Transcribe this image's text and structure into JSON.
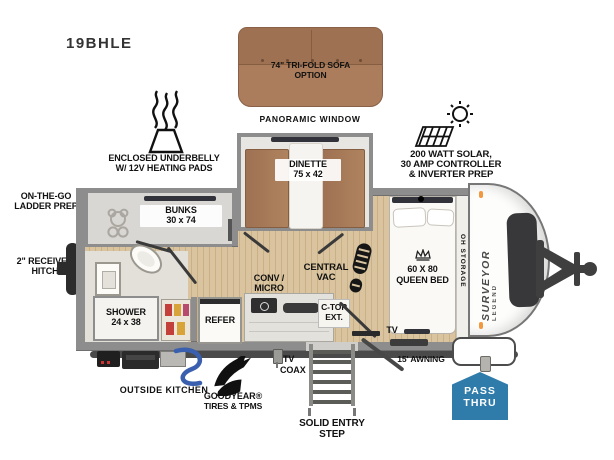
{
  "model": "19BHLE",
  "colors": {
    "accent_blue": "#2f7cab",
    "sofa_brown": "#ab7d5d",
    "wall_gray": "#8d8d8d",
    "floor_wood": "#d9c49f",
    "hose_blue": "#3a5fae",
    "marker_orange": "#f2993f"
  },
  "labels": {
    "tri_fold_sofa": [
      "74\" TRI-FOLD SOFA",
      "OPTION"
    ],
    "panoramic_window": "PANORAMIC WINDOW",
    "enclosed_underbelly": [
      "ENCLOSED UNDERBELLY",
      "W/ 12V HEATING PADS"
    ],
    "solar_prep": [
      "200 WATT SOLAR,",
      "30 AMP CONTROLLER",
      "& INVERTER PREP"
    ],
    "ladder_prep": [
      "ON-THE-GO",
      "LADDER PREP"
    ],
    "receiver_hitch": [
      "2\" RECEIVER",
      "HITCH"
    ],
    "bunks": [
      "BUNKS",
      "30 x 74"
    ],
    "dinette": [
      "DINETTE",
      "75 x 42"
    ],
    "central_vac": [
      "CENTRAL",
      "VAC"
    ],
    "queen_bed": [
      "60 X 80",
      "QUEEN BED"
    ],
    "oh_storage": "OH STORAGE",
    "brand": [
      "SURVEYOR",
      "LEGEND"
    ],
    "shower": [
      "SHOWER",
      "24 x 38"
    ],
    "refer": "REFER",
    "conv_micro": [
      "CONV /",
      "MICRO"
    ],
    "ctop_ext": [
      "C-TOP",
      "EXT."
    ],
    "tv": "TV",
    "tv_coax": [
      "TV",
      "COAX"
    ],
    "outside_kitchen": "OUTSIDE KITCHEN",
    "goodyear": [
      "GOODYEAR®",
      "TIRES & TPMS"
    ],
    "solid_entry_step": [
      "SOLID ENTRY",
      "STEP"
    ],
    "awning": "15' AWNING",
    "pass_thru": [
      "PASS",
      "THRU"
    ]
  }
}
